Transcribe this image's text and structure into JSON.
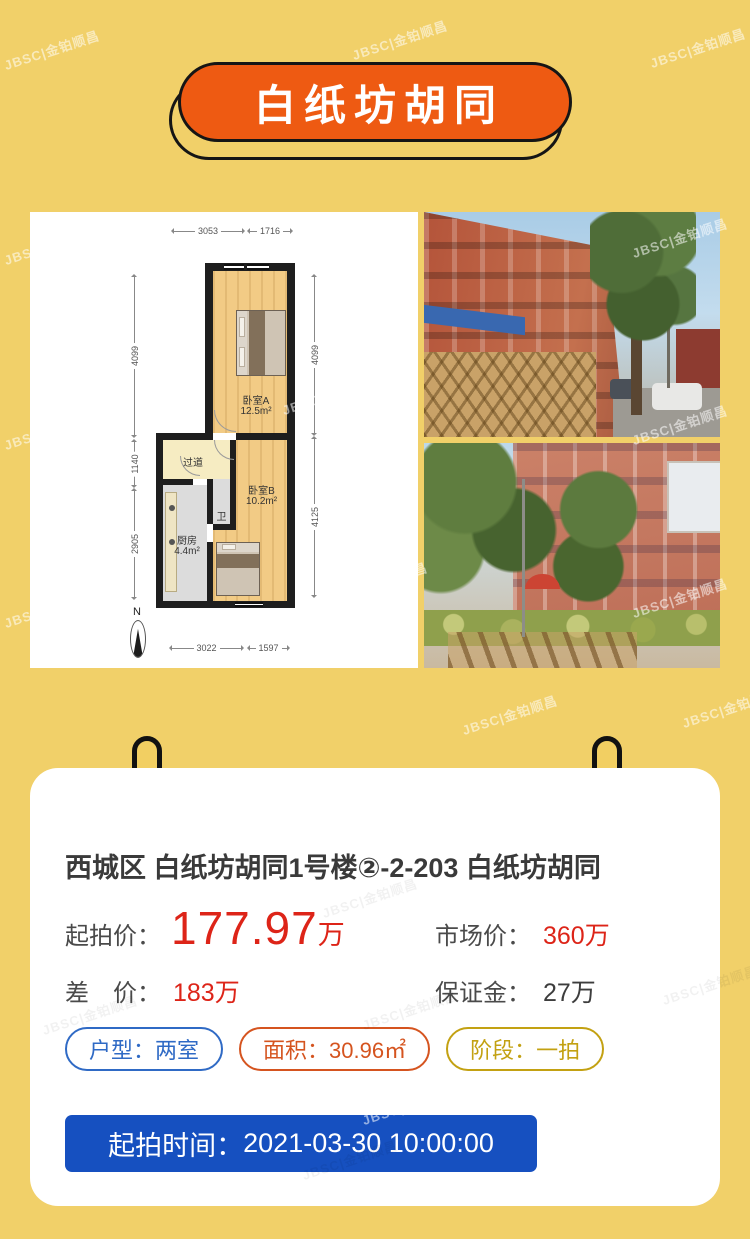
{
  "colors": {
    "background": "#f1d069",
    "banner_orange": "#ee5a12",
    "price_red": "#dd2418",
    "button_blue": "#1650c0",
    "badge_blue": "#2f6ac5",
    "badge_orange": "#d5541f",
    "badge_gold": "#c3a112"
  },
  "watermark": {
    "text": "JBSC|金铂顺昌"
  },
  "banner": {
    "title": "白纸坊胡同"
  },
  "floorplan": {
    "dims": {
      "top": [
        "3053",
        "1716"
      ],
      "left": [
        "4099",
        "1140",
        "2905"
      ],
      "right": [
        "4099",
        "4125"
      ],
      "bottom": [
        "3022",
        "1597"
      ]
    },
    "rooms": {
      "bedroomA": {
        "name": "卧室A",
        "area": "12.5m²"
      },
      "bedroomB": {
        "name": "卧室B",
        "area": "10.2m²"
      },
      "kitchen": {
        "name": "厨房",
        "area": "4.4m²"
      },
      "hallway": {
        "name": "过道"
      },
      "bath": {
        "name": "卫"
      }
    },
    "compass": "N"
  },
  "photos": {
    "photo1_alt": "street-view photo of red brick building",
    "photo2_alt": "courtyard photo of apartment building with trees"
  },
  "card": {
    "title": "西城区 白纸坊胡同1号楼②-2-203 白纸坊胡同",
    "start_price": {
      "label": "起拍价：",
      "value": "177.97",
      "unit": "万"
    },
    "market_price": {
      "label": "市场价：",
      "value": "360万"
    },
    "diff_price": {
      "label": "差　价：",
      "value": "183万"
    },
    "deposit": {
      "label": "保证金：",
      "value": "27万"
    },
    "badges": [
      {
        "label": "户型：",
        "value": "两室"
      },
      {
        "label": "面积：",
        "value": "30.96㎡"
      },
      {
        "label": "阶段：",
        "value": "一拍"
      }
    ],
    "start_time": {
      "label": "起拍时间：",
      "value": "2021-03-30 10:00:00"
    }
  }
}
